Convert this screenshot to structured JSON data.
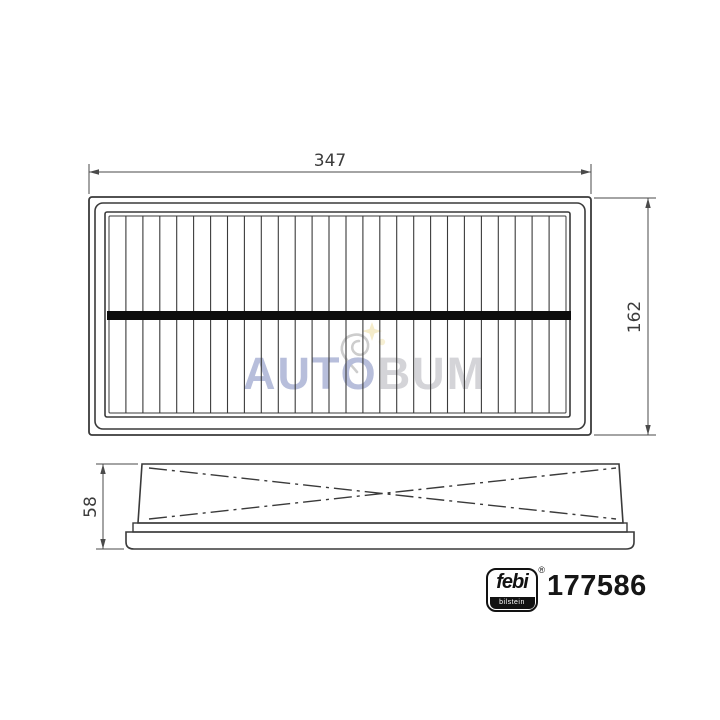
{
  "page": {
    "background": "#ffffff"
  },
  "drawing": {
    "type": "technical-drawing-air-filter",
    "line_color": "#3a3a3a",
    "dim_line_color": "#4a4a4a",
    "support_bar_color": "#0d0d0d",
    "views": {
      "top": {
        "pleat_count": 26
      },
      "side": {
        "hatch_style": "dash-dot-cross"
      }
    },
    "dimensions": {
      "width": "347",
      "height": "162",
      "depth": "58"
    }
  },
  "watermark": {
    "text_primary": "AUTO",
    "text_secondary": "BUM",
    "color_primary": "#b7bedb",
    "color_secondary": "#d4d4d8"
  },
  "brand": {
    "logo_name": "febi",
    "logo_subtitle": "bilstein",
    "registered_mark": "®",
    "part_number": "177586",
    "logo_color": "#121212"
  }
}
